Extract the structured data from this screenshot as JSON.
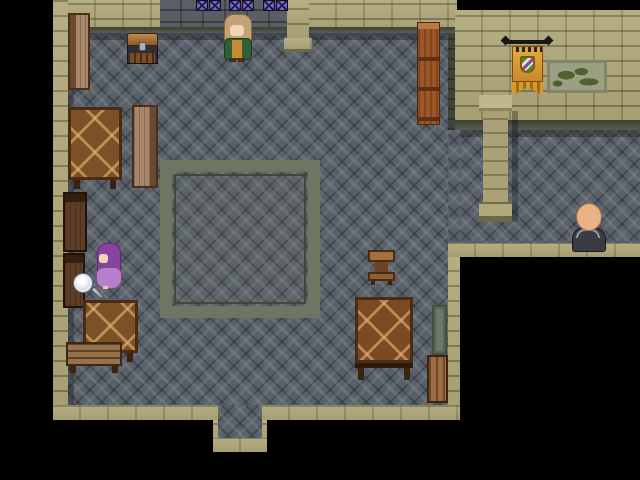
{
  "scene": {
    "type": "rpg-top-down-interior",
    "description": "Stone guild-hall interior with dark diamond-tiled floor, tan brick walls, a square floor inlay, a right-side corridor, and black out-of-bounds areas",
    "background_color": "#000000",
    "hud_text": "none"
  },
  "palette": {
    "floor": "#596069",
    "floor_inlay_border": "#6e7663",
    "wall_tan": "#b0a87b",
    "wall_dark_stone": "#5a5f66",
    "wall_shadow_band": "#4f5546",
    "window_purple": "#7a4bbf",
    "window_blue": "#5a8ae0",
    "wood_dark": "#5e3e26",
    "wood_mid": "#7d5128",
    "wood_light": "#a8876a",
    "banner_gold": "#d89a2a",
    "map_green": "#51602f",
    "out_of_bounds": "#000000"
  },
  "windows": {
    "label": "stained-glass windows",
    "count": 6,
    "arrangement": "three pairs on top wall",
    "colors": [
      "#7a4bbf",
      "#5a8ae0"
    ]
  },
  "characters": {
    "elder": {
      "label": "elder NPC in green coat with long blond hair",
      "hair": "#c4a276",
      "coat": "#2f5f38",
      "robe": "#c78a35",
      "facing": "down"
    },
    "purple_girl": {
      "label": "purple-haired woman in lavender dress",
      "hair": "#8a42a0",
      "dress": "#b77fc9",
      "facing": "left"
    },
    "monk": {
      "label": "bald monk in dark robe",
      "head": "#eab386",
      "robe": "#3b3b43",
      "facing": "up"
    }
  },
  "objects": {
    "chest": {
      "label": "treasure chest",
      "lid": "#8a5a28",
      "body": "#2e2e34"
    },
    "banner": {
      "label": "gold wall banner with striped shield emblem",
      "color": "#d89a2a"
    },
    "wall_map": {
      "label": "framed wall map with green continents",
      "color": "#9ba083"
    },
    "east_shelf": {
      "label": "tall orange-brown shelf against east wall"
    },
    "pillar": {
      "label": "stone pillar",
      "color": "#aaa276"
    },
    "top_pillar": {
      "label": "wall pillar on top wall"
    },
    "table_upper": {
      "label": "patterned wooden table (upper left)"
    },
    "table_lower": {
      "label": "patterned wooden table (lower left)"
    },
    "table_center": {
      "label": "patterned wooden table (bottom center)"
    },
    "chair_upper": {
      "label": "wooden chair (top left, side view)"
    },
    "chair_right": {
      "label": "wooden chair facing table"
    },
    "cabinet_upper": {
      "label": "dark wooden cabinet on left wall"
    },
    "cabinet_lower": {
      "label": "dark wooden cabinet on left wall (lower)"
    },
    "bench": {
      "label": "wooden bench"
    },
    "stool": {
      "label": "small wooden side table"
    },
    "crate": {
      "label": "wooden crate by east wall"
    },
    "leaning_board": {
      "label": "gray-green board leaning on east wall"
    },
    "doorway": {
      "label": "doorway alcove in bottom wall"
    }
  },
  "cursor": {
    "magnifier": {
      "label": "magnifying-glass examine cursor",
      "lens": "#dce6f2"
    }
  }
}
